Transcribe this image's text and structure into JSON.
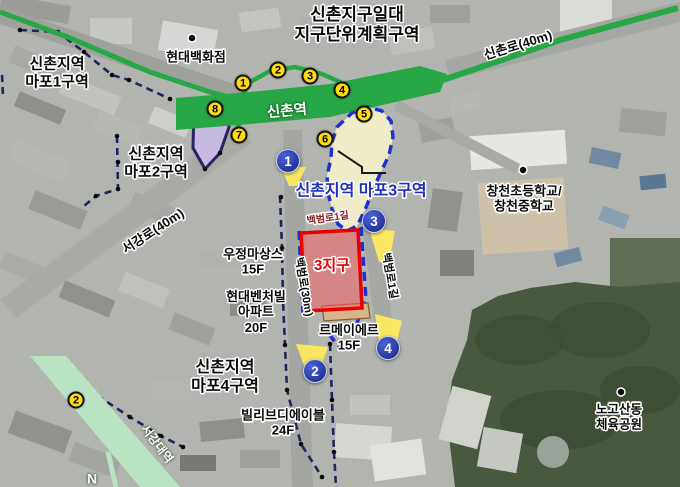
{
  "title": "신촌지구일대\n지구단위계획구역",
  "station": {
    "sinchon": "신촌역",
    "sogang": "서강대역"
  },
  "roads": {
    "sinchon_ro": "신촌로(40m)",
    "sogang_ro": "서강로(40m)",
    "baekbeom_ro": "백범로(30m)",
    "baekbeom_1gil_a": "백범로1길",
    "baekbeom_1gil_b": "백범로1길"
  },
  "zones": {
    "mapo1": "신촌지역\n마포1구역",
    "mapo2": "신촌지역\n마포2구역",
    "mapo3": "신촌지역 마포3구역",
    "mapo4": "신촌지역\n마포4구역",
    "district3": "3지구"
  },
  "places": {
    "hyundai_dept": "현대백화점",
    "changcheon_schools": "창천초등학교/\n창천중학교",
    "nogosan_park": "노고산동\n체육공원",
    "woojung": "우정마상스\n15F",
    "hyundai_venture": "현대벤처빌\n아파트\n20F",
    "lemeilleur": "르메이에르\n15F",
    "villive": "빌리브디에이블\n24F"
  },
  "compass": "N",
  "exit_markers": [
    "1",
    "2",
    "3",
    "4",
    "5",
    "6",
    "7",
    "8"
  ],
  "extra_yellow_marker": "2",
  "view_markers": [
    "1",
    "2",
    "3",
    "4"
  ],
  "colors": {
    "road_green": "#28a746",
    "road_mint": "#b9e4c4",
    "marker_yellow": "#ffd912",
    "marker_blue": "#16247e",
    "district_red": "#e60000",
    "zone_fill": "#f3efc8",
    "zone_border_blue": "#2030cf",
    "boundary_navy": "#23235f",
    "zone3_text_blue": "#1d2ec0",
    "street_maroon": "#8b2020"
  }
}
